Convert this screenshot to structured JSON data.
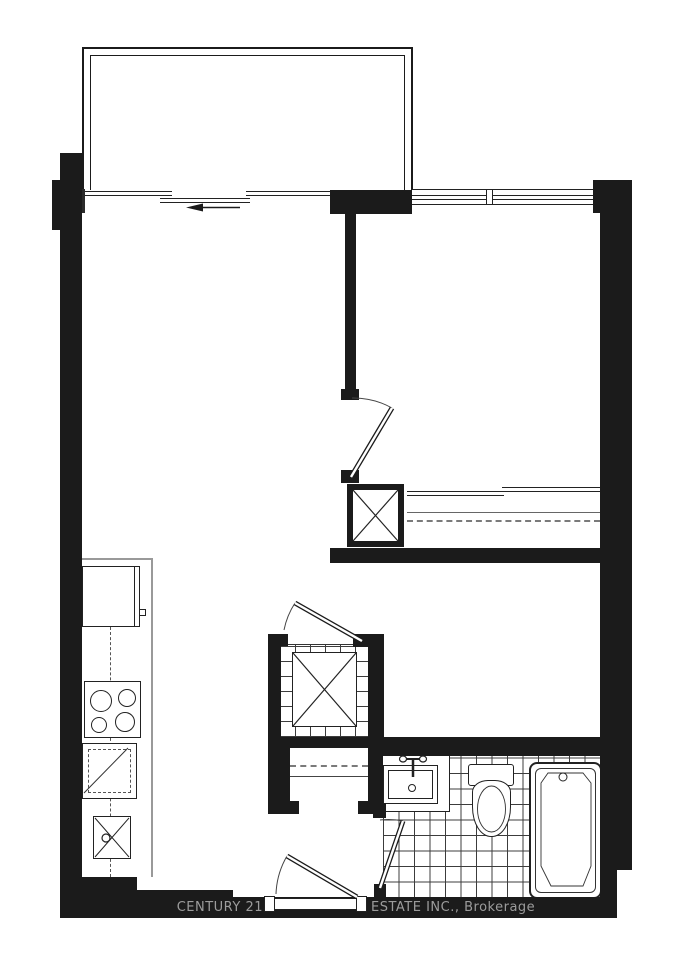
{
  "watermark": {
    "left": "CENTURY 21",
    "right": "ESTATE INC., Brokerage"
  },
  "palette": {
    "wall": "#1b1b1b",
    "line": "#2b2b2b",
    "muted_line": "#999999",
    "watermark_text": "#9c9c9c",
    "background": "#ffffff"
  },
  "fixtures": [
    "balcony-railing",
    "balcony-sliding-door",
    "slide-direction-arrow",
    "window",
    "bedroom-door",
    "bedroom-closet-sliding-doors",
    "closet-rod",
    "utility-shaft",
    "laundry-closet-door",
    "stacked-washer-dryer",
    "entry-closet",
    "refrigerator",
    "kitchen-counter",
    "cooktop-burners",
    "dishwasher",
    "kitchen-sink",
    "bathroom-door",
    "vanity-sink",
    "faucet",
    "toilet",
    "bathtub",
    "tile-floor",
    "entry-door"
  ]
}
